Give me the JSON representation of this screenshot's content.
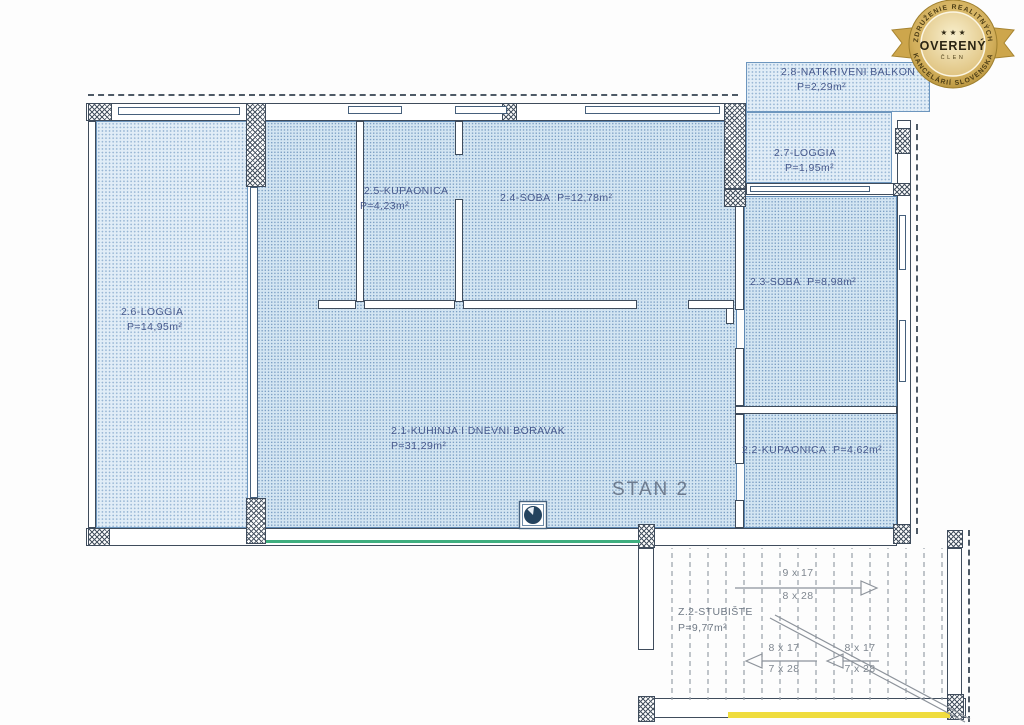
{
  "badge": {
    "arc_top": "ZDRUŽENIE REALITNÝCH",
    "arc_bottom": "KANCELÁRIÍ SLOVENSKA",
    "stars": "★ ★ ★",
    "title": "OVERENÝ",
    "subtitle": "ČLEN"
  },
  "plan": {
    "unit_label": "STAN 2",
    "rooms": {
      "balkon": {
        "name": "2.8-NATKRIVENI BALKON",
        "area": "P=2,29m²"
      },
      "loggia_27": {
        "name": "2.7-LOGGIA",
        "area": "P=1,95m²"
      },
      "kupaonica_25": {
        "name": "2.5-KUPAONICA",
        "area": "P=4,23m²"
      },
      "soba_24": {
        "name": "2.4-SOBA",
        "area": "P=12,78m²"
      },
      "soba_23": {
        "name": "2.3-SOBA",
        "area": "P=8,98m²"
      },
      "loggia_26": {
        "name": "2.6-LOGGIA",
        "area": "P=14,95m²"
      },
      "kuhinja_21": {
        "name": "2.1-KUHINJA I DNEVNI BORAVAK",
        "area": "P=31,29m²"
      },
      "kupaonica_22": {
        "name": "2.2-KUPAONICA",
        "area": "P=4,62m²"
      },
      "stubiste": {
        "name": "Z.2-STUBIŠTE",
        "area": "P=9,77m²"
      }
    },
    "stairs": {
      "run_up": {
        "steps": "9 x 17",
        "tread": "8 x 28"
      },
      "run_mid": {
        "steps": "8 x 17",
        "tread": "7 x 28"
      },
      "run_low": {
        "steps": "8 x 17",
        "tread": "7 x 28"
      }
    }
  },
  "colors": {
    "hatch_fill": "#d3e5f2",
    "plan_line": "#3f4c5c",
    "label_text": "#47598c",
    "stair_text": "#7e868f",
    "badge_gold": "#c8a34e",
    "accent_green": "#3fae7f",
    "accent_yellow": "#efdc3e"
  }
}
